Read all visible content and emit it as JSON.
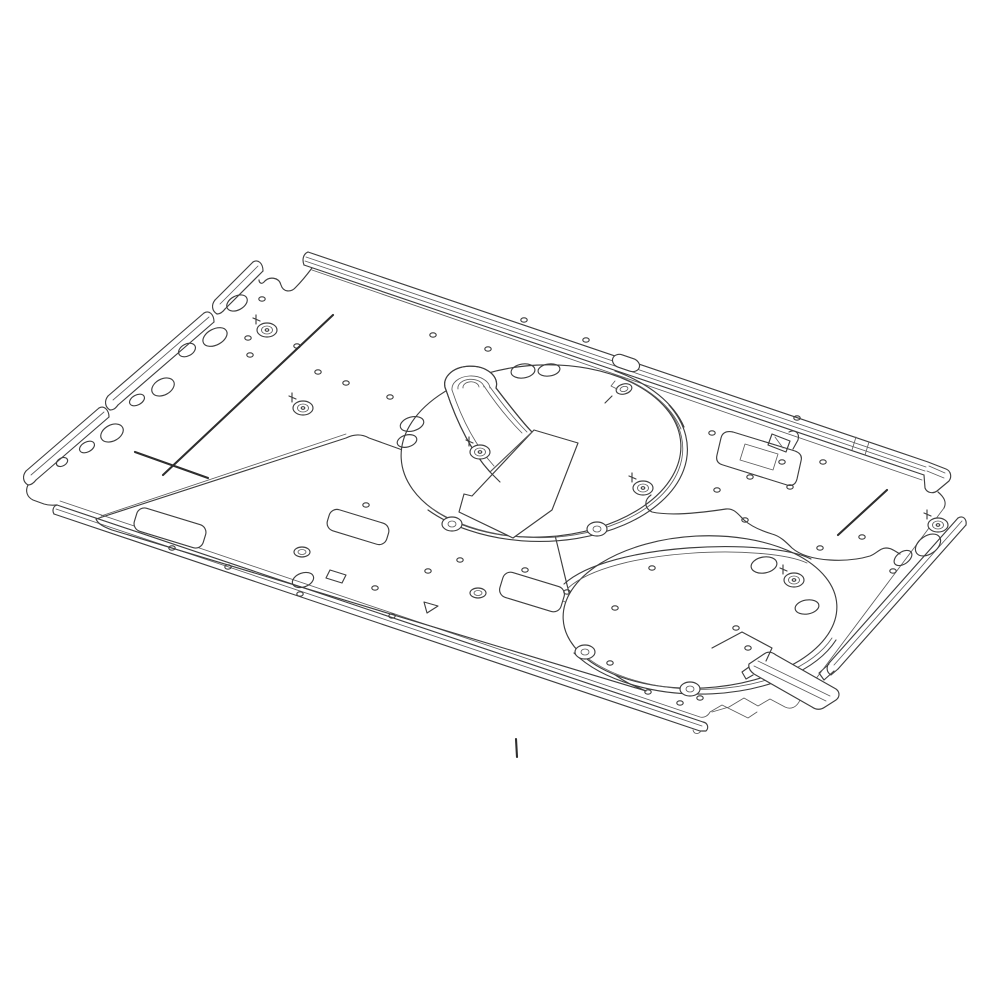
{
  "meta": {
    "type": "technical-line-drawing",
    "description": "Isometric CAD line drawing of a sheet-metal appliance base panel with two large circular blower openings, a scroll duct, stamped emboss plateau, flanged edge rails, corner brackets and mounting holes",
    "background_color": "#ffffff",
    "line_color": "#3f3f3f",
    "crease_color": "#2e2e2e"
  },
  "drawing": {
    "parts": [
      "top-edge-rail",
      "left-edge-rail-segments",
      "bottom-edge-rail",
      "right-edge-rail",
      "blower-opening-front",
      "blower-opening-rear",
      "scroll-duct",
      "cover-plate",
      "emboss-plateau",
      "mounting-bracket",
      "z-bracket",
      "mounting-bosses",
      "stray-tick"
    ],
    "bosses": [
      {
        "x": 267,
        "y": 330
      },
      {
        "x": 303,
        "y": 408
      },
      {
        "x": 480,
        "y": 452
      },
      {
        "x": 643,
        "y": 488
      },
      {
        "x": 794,
        "y": 580
      },
      {
        "x": 938,
        "y": 525
      }
    ],
    "ring_holes": [
      {
        "x": 302,
        "y": 552
      },
      {
        "x": 478,
        "y": 593
      }
    ],
    "oval_holes": [
      {
        "x": 237,
        "y": 303,
        "rx": 11,
        "ry": 7,
        "rot": -28
      },
      {
        "x": 215,
        "y": 337,
        "rx": 13,
        "ry": 8,
        "rot": -28
      },
      {
        "x": 187,
        "y": 350,
        "rx": 9,
        "ry": 6,
        "rot": -28
      },
      {
        "x": 163,
        "y": 387,
        "rx": 12,
        "ry": 8,
        "rot": -28
      },
      {
        "x": 137,
        "y": 400,
        "rx": 8,
        "ry": 5,
        "rot": -28
      },
      {
        "x": 112,
        "y": 433,
        "rx": 12,
        "ry": 8,
        "rot": -28
      },
      {
        "x": 87,
        "y": 447,
        "rx": 8,
        "ry": 5,
        "rot": -28
      },
      {
        "x": 62,
        "y": 462,
        "rx": 6,
        "ry": 4,
        "rot": -28
      },
      {
        "x": 523,
        "y": 371,
        "rx": 12,
        "ry": 7,
        "rot": -8
      },
      {
        "x": 549,
        "y": 370,
        "rx": 11,
        "ry": 6,
        "rot": -8
      },
      {
        "x": 412,
        "y": 424,
        "rx": 12,
        "ry": 7,
        "rot": -15
      },
      {
        "x": 407,
        "y": 441,
        "rx": 10,
        "ry": 6,
        "rot": -15
      },
      {
        "x": 928,
        "y": 545,
        "rx": 14,
        "ry": 9,
        "rot": -35
      },
      {
        "x": 903,
        "y": 558,
        "rx": 10,
        "ry": 6,
        "rot": -35
      },
      {
        "x": 807,
        "y": 607,
        "rx": 12,
        "ry": 7,
        "rot": -10
      },
      {
        "x": 764,
        "y": 565,
        "rx": 13,
        "ry": 8,
        "rot": -10
      },
      {
        "x": 303,
        "y": 580,
        "rx": 11,
        "ry": 7,
        "rot": -20
      }
    ],
    "small_holes": [
      {
        "x": 262,
        "y": 299
      },
      {
        "x": 248,
        "y": 338
      },
      {
        "x": 250,
        "y": 355
      },
      {
        "x": 297,
        "y": 346
      },
      {
        "x": 318,
        "y": 372
      },
      {
        "x": 346,
        "y": 383
      },
      {
        "x": 390,
        "y": 397
      },
      {
        "x": 433,
        "y": 335
      },
      {
        "x": 488,
        "y": 349
      },
      {
        "x": 524,
        "y": 320
      },
      {
        "x": 586,
        "y": 340
      },
      {
        "x": 712,
        "y": 433
      },
      {
        "x": 717,
        "y": 490
      },
      {
        "x": 790,
        "y": 487
      },
      {
        "x": 797,
        "y": 418
      },
      {
        "x": 823,
        "y": 462
      },
      {
        "x": 862,
        "y": 537
      },
      {
        "x": 893,
        "y": 571
      },
      {
        "x": 172,
        "y": 548
      },
      {
        "x": 228,
        "y": 567
      },
      {
        "x": 392,
        "y": 616
      },
      {
        "x": 300,
        "y": 594
      },
      {
        "x": 366,
        "y": 505
      },
      {
        "x": 428,
        "y": 571
      },
      {
        "x": 460,
        "y": 560
      },
      {
        "x": 525,
        "y": 570
      },
      {
        "x": 567,
        "y": 592
      },
      {
        "x": 615,
        "y": 608
      },
      {
        "x": 375,
        "y": 588
      },
      {
        "x": 610,
        "y": 663
      },
      {
        "x": 648,
        "y": 692
      },
      {
        "x": 680,
        "y": 703
      },
      {
        "x": 700,
        "y": 698
      },
      {
        "x": 652,
        "y": 568
      },
      {
        "x": 736,
        "y": 628
      },
      {
        "x": 748,
        "y": 648
      },
      {
        "x": 745,
        "y": 520
      },
      {
        "x": 820,
        "y": 548
      },
      {
        "x": 750,
        "y": 477
      },
      {
        "x": 782,
        "y": 462
      }
    ],
    "crease_lines": [
      {
        "x1": 333,
        "y1": 315,
        "x2": 163,
        "y2": 475
      },
      {
        "x1": 135,
        "y1": 452,
        "x2": 208,
        "y2": 478
      },
      {
        "x1": 887,
        "y1": 490,
        "x2": 838,
        "y2": 535
      },
      {
        "x1": 516,
        "y1": 739,
        "x2": 517,
        "y2": 757
      }
    ],
    "rim_tabs": [
      {
        "x": 452,
        "y": 524
      },
      {
        "x": 597,
        "y": 529
      },
      {
        "x": 585,
        "y": 652
      },
      {
        "x": 690,
        "y": 689
      }
    ],
    "tabs": [
      {
        "cx": 170,
        "cy": 528,
        "w": 72,
        "h": 24,
        "rot": 17
      },
      {
        "cx": 358,
        "cy": 527,
        "w": 62,
        "h": 22,
        "rot": 17
      },
      {
        "cx": 532,
        "cy": 592,
        "w": 64,
        "h": 26,
        "rot": 17
      },
      {
        "cx": 626,
        "cy": 363,
        "w": 28,
        "h": 13,
        "rot": 19
      }
    ]
  }
}
